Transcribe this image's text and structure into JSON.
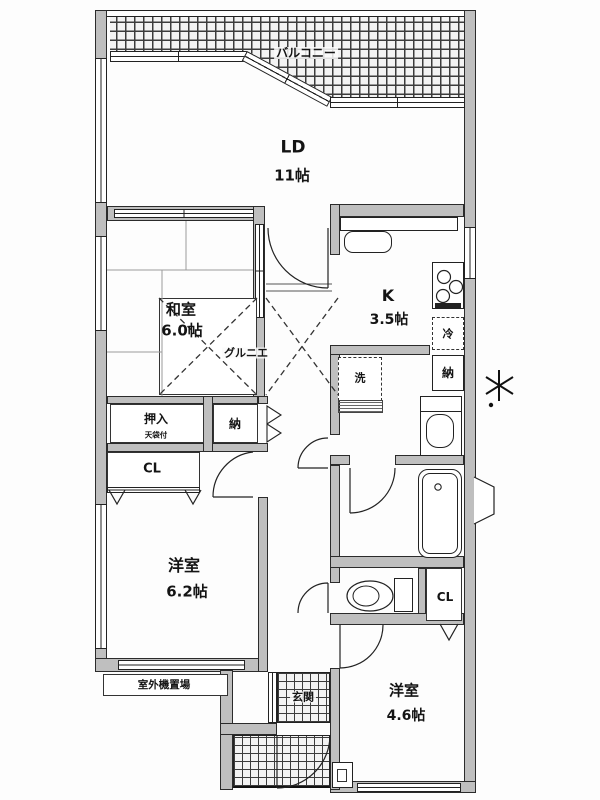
{
  "balcony": {
    "label": "バルコニー"
  },
  "rooms": {
    "ld": {
      "name": "LD",
      "size": "11帖"
    },
    "washitsu": {
      "name": "和室",
      "size": "6.0帖"
    },
    "kitchen": {
      "name": "K",
      "size": "3.5帖"
    },
    "western1": {
      "name": "洋室",
      "size": "6.2帖"
    },
    "western2": {
      "name": "洋室",
      "size": "4.6帖"
    }
  },
  "closets": {
    "oshiire": "押入",
    "oshiire_note": "天袋付",
    "storage_hall": "納",
    "storage_wash": "納",
    "closet1": "CL",
    "closet2": "CL",
    "grenier": "グルニエ"
  },
  "fixtures": {
    "fridge": "冷",
    "washer": "洗"
  },
  "labels": {
    "entrance": "玄関",
    "outdoor_unit": "室外機置場"
  },
  "colors": {
    "wall_fill": "#bfbfbf",
    "line": "#222222",
    "paper": "#fdfdfd"
  }
}
